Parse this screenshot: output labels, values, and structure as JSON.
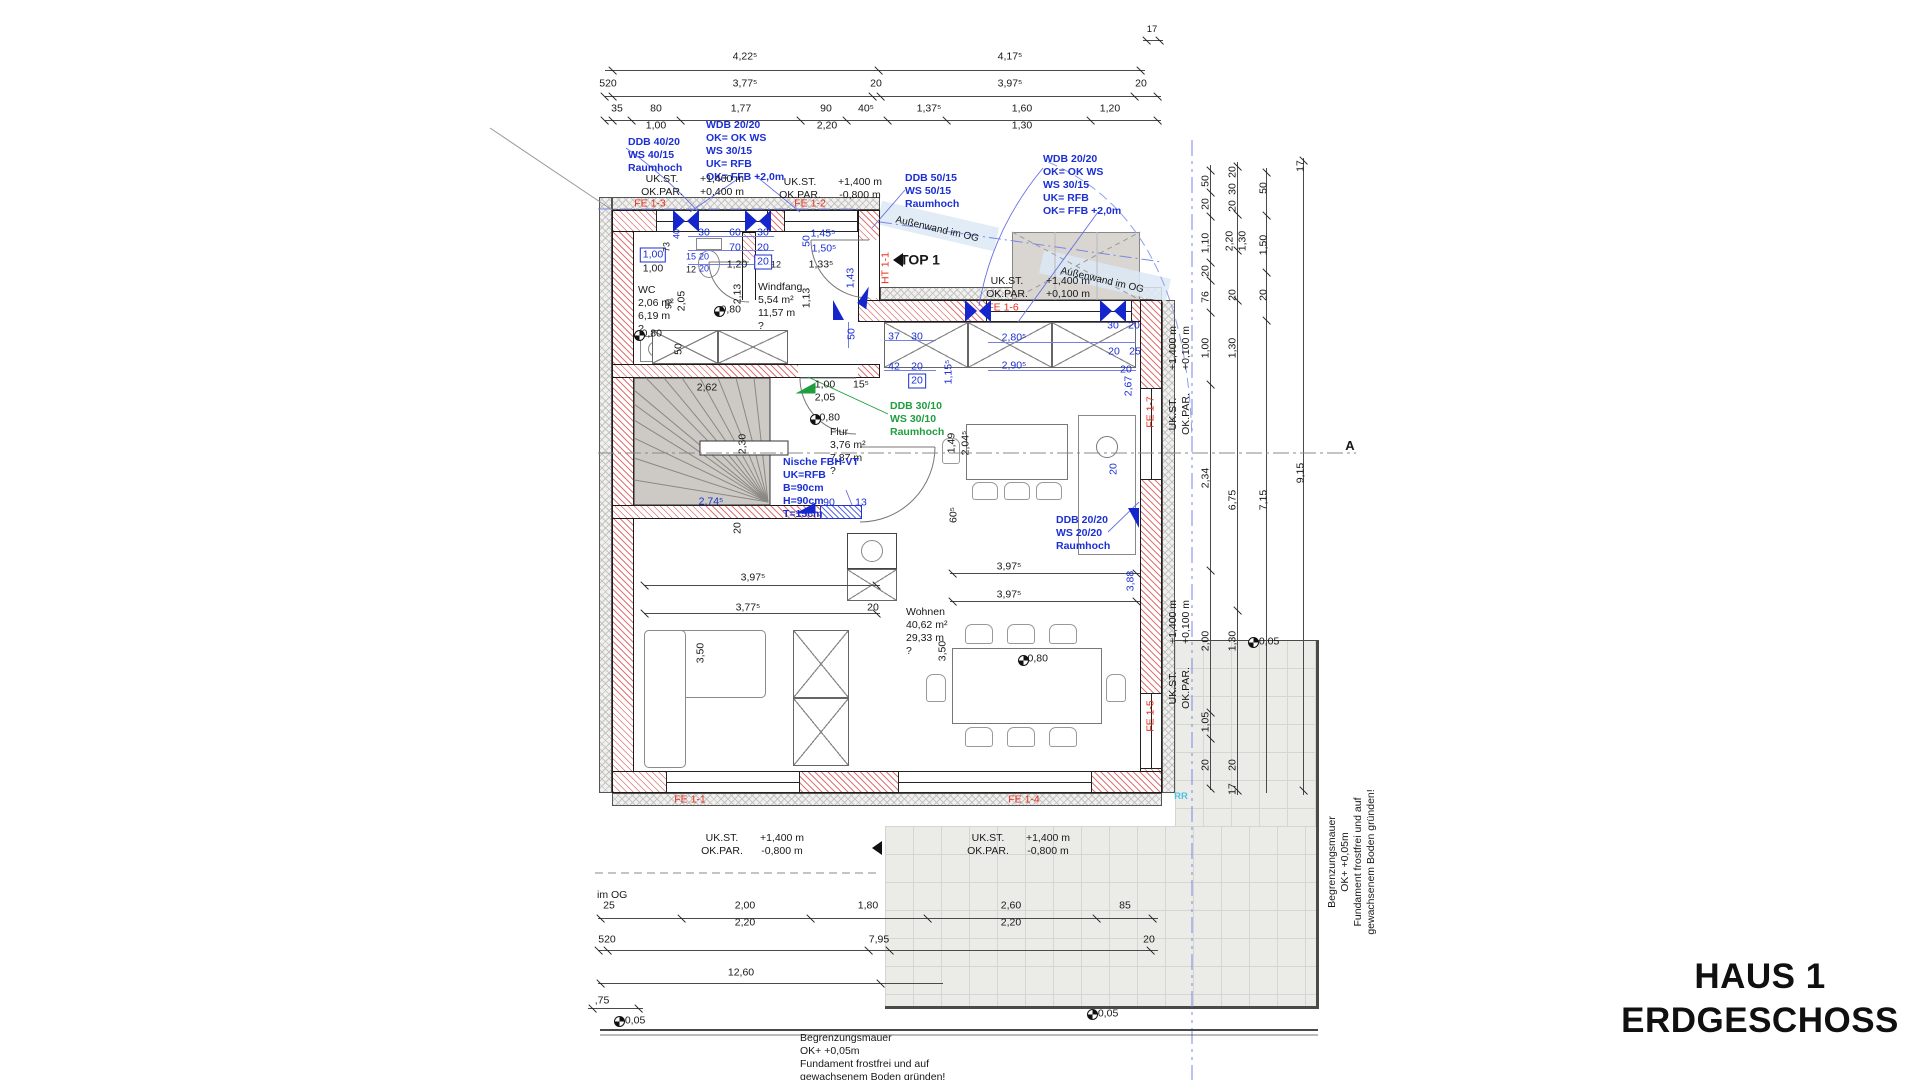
{
  "title": {
    "line1": "HAUS 1",
    "line2": "ERDGESCHOSS"
  },
  "accent_colors": {
    "dimension_blue": "#1b2fd4",
    "note_green": "#1f9e3e",
    "window_red": "#e8301c",
    "axis_cyan": "#49c4e6"
  },
  "labels": [
    {
      "t": "4,22⁵",
      "x": 745,
      "y": 57
    },
    {
      "t": "4,17⁵",
      "x": 1010,
      "y": 57
    },
    {
      "t": "17",
      "x": 1152,
      "y": 30,
      "s": 9.5
    },
    {
      "t": "520",
      "x": 608,
      "y": 84
    },
    {
      "t": "3,77⁵",
      "x": 745,
      "y": 84
    },
    {
      "t": "20",
      "x": 876,
      "y": 84
    },
    {
      "t": "3,97⁵",
      "x": 1010,
      "y": 84
    },
    {
      "t": "20",
      "x": 1141,
      "y": 84
    },
    {
      "t": "35",
      "x": 617,
      "y": 109
    },
    {
      "t": "80",
      "x": 656,
      "y": 109
    },
    {
      "t": "1,77",
      "x": 741,
      "y": 109
    },
    {
      "t": "90",
      "x": 826,
      "y": 109
    },
    {
      "t": "40⁵",
      "x": 866,
      "y": 109
    },
    {
      "t": "1,37⁵",
      "x": 929,
      "y": 109
    },
    {
      "t": "1,60",
      "x": 1022,
      "y": 109
    },
    {
      "t": "1,20",
      "x": 1110,
      "y": 109
    },
    {
      "t": "1,00",
      "x": 656,
      "y": 126
    },
    {
      "t": "2,20",
      "x": 827,
      "y": 126
    },
    {
      "t": "1,30",
      "x": 1022,
      "y": 126
    },
    {
      "n": "annotation-ddb-40",
      "t": "DDB 40/20\nWS 40/15\nRaumhoch",
      "x": 628,
      "y": 136,
      "c": "b",
      "a": "l",
      "fw": 1
    },
    {
      "n": "annotation-wdb-left",
      "t": "WDB 20/20\nOK= OK WS\nWS 30/15\nUK= RFB\nOK= FFB +2,0m",
      "x": 706,
      "y": 119,
      "c": "b",
      "a": "l",
      "fw": 1
    },
    {
      "n": "annotation-ddb-50",
      "t": "DDB 50/15\nWS 50/15\nRaumhoch",
      "x": 905,
      "y": 172,
      "c": "b",
      "a": "l",
      "fw": 1
    },
    {
      "n": "annotation-wdb-right",
      "t": "WDB 20/20\nOK= OK WS\nWS 30/15\nUK= RFB\nOK= FFB +2,0m",
      "x": 1043,
      "y": 153,
      "c": "b",
      "a": "l",
      "fw": 1
    },
    {
      "t": "UK.ST.\nOK.PAR.",
      "x": 662,
      "y": 186
    },
    {
      "t": "+1,400 m\n+0,400 m",
      "x": 722,
      "y": 186
    },
    {
      "t": "UK.ST.\nOK.PAR.",
      "x": 800,
      "y": 189
    },
    {
      "t": "+1,400 m\n-0,800 m",
      "x": 860,
      "y": 189
    },
    {
      "t": "UK.ST.\nOK.PAR.",
      "x": 1007,
      "y": 288
    },
    {
      "t": "+1,400 m\n+0,100 m",
      "x": 1068,
      "y": 288
    },
    {
      "n": "window-label-fe1-3",
      "t": "FE 1-3",
      "x": 650,
      "y": 204,
      "c": "r"
    },
    {
      "n": "window-label-fe1-2",
      "t": "FE 1-2",
      "x": 810,
      "y": 204,
      "c": "r"
    },
    {
      "n": "window-label-fe1-6",
      "t": "FE 1-6",
      "x": 1003,
      "y": 308,
      "c": "r"
    },
    {
      "n": "door-label-ht1-1",
      "t": "HT 1-1",
      "x": 886,
      "y": 268,
      "c": "r",
      "r": -90
    },
    {
      "n": "window-label-fe1-7",
      "t": "FE 1-7",
      "x": 1151,
      "y": 412,
      "c": "r",
      "r": -90
    },
    {
      "n": "window-label-fe1-5",
      "t": "FE 1-5",
      "x": 1151,
      "y": 716,
      "c": "r",
      "r": -90
    },
    {
      "n": "window-label-fe1-1",
      "t": "FE 1-1",
      "x": 690,
      "y": 800,
      "c": "r"
    },
    {
      "n": "window-label-fe1-4",
      "t": "FE 1-4",
      "x": 1024,
      "y": 800,
      "c": "r"
    },
    {
      "n": "og-wall-note",
      "t": "Außenwand im OG",
      "x": 937,
      "y": 230,
      "r": 13,
      "s": 10
    },
    {
      "n": "og-wall-note",
      "t": "Außenwand im OG",
      "x": 1102,
      "y": 281,
      "r": 13,
      "s": 10
    },
    {
      "n": "top1-label",
      "t": "TOP 1",
      "x": 920,
      "y": 260,
      "s": 14,
      "fw": 1
    },
    {
      "n": "room-wc",
      "t": "WC\n2,06 m²\n6,19 m\n?",
      "x": 638,
      "y": 284,
      "a": "l"
    },
    {
      "t": "90",
      "x": 669,
      "y": 304,
      "r": -90,
      "s": 9
    },
    {
      "t": "2,05",
      "x": 682,
      "y": 301,
      "r": -90
    },
    {
      "t": "-0,80",
      "x": 729,
      "y": 310
    },
    {
      "t": "2,13",
      "x": 738,
      "y": 294,
      "r": -90
    },
    {
      "n": "room-windfang",
      "t": "Windfang\n5,54 m²\n11,57 m\n?",
      "x": 758,
      "y": 281,
      "a": "l"
    },
    {
      "t": "1,13",
      "x": 807,
      "y": 298,
      "r": -90
    },
    {
      "t": "-0,80",
      "x": 650,
      "y": 334
    },
    {
      "t": "50",
      "x": 679,
      "y": 349,
      "r": -90
    },
    {
      "t": "1,00",
      "x": 653,
      "y": 255,
      "c": "b",
      "bx": 1
    },
    {
      "t": "1,00",
      "x": 653,
      "y": 269
    },
    {
      "t": "40",
      "x": 677,
      "y": 234,
      "r": -90,
      "c": "b",
      "s": 9
    },
    {
      "t": "73",
      "x": 667,
      "y": 247,
      "r": -90,
      "s": 9
    },
    {
      "t": "15",
      "x": 691,
      "y": 257,
      "c": "b",
      "s": 9
    },
    {
      "t": "20",
      "x": 704,
      "y": 257,
      "c": "b",
      "s": 9
    },
    {
      "t": "20",
      "x": 704,
      "y": 269,
      "c": "b",
      "s": 9
    },
    {
      "t": "12",
      "x": 691,
      "y": 270,
      "s": 9
    },
    {
      "t": "30",
      "x": 704,
      "y": 233,
      "c": "b"
    },
    {
      "t": "60",
      "x": 735,
      "y": 233,
      "c": "b"
    },
    {
      "t": "30",
      "x": 763,
      "y": 233,
      "c": "b"
    },
    {
      "t": "70",
      "x": 735,
      "y": 248,
      "c": "b"
    },
    {
      "t": "20",
      "x": 763,
      "y": 248,
      "c": "b"
    },
    {
      "t": "20",
      "x": 763,
      "y": 262,
      "c": "b",
      "bx": 1
    },
    {
      "t": "1,20",
      "x": 737,
      "y": 265
    },
    {
      "t": "12",
      "x": 776,
      "y": 265,
      "s": 9
    },
    {
      "t": "1,45⁵",
      "x": 823,
      "y": 234,
      "c": "b"
    },
    {
      "t": "1,50⁵",
      "x": 824,
      "y": 249,
      "c": "b"
    },
    {
      "t": "1,33⁵",
      "x": 821,
      "y": 265
    },
    {
      "t": "50",
      "x": 807,
      "y": 241,
      "r": -90,
      "c": "b"
    },
    {
      "t": "1,43",
      "x": 851,
      "y": 278,
      "r": -90,
      "c": "b"
    },
    {
      "t": "2,62",
      "x": 707,
      "y": 388
    },
    {
      "t": "2,30",
      "x": 743,
      "y": 444,
      "r": -90
    },
    {
      "t": "1,00",
      "x": 825,
      "y": 385
    },
    {
      "t": "2,05",
      "x": 825,
      "y": 398
    },
    {
      "t": "15⁵",
      "x": 861,
      "y": 385
    },
    {
      "t": "50",
      "x": 852,
      "y": 334,
      "r": -90,
      "c": "b"
    },
    {
      "t": "37",
      "x": 894,
      "y": 337,
      "c": "b"
    },
    {
      "t": "30",
      "x": 917,
      "y": 337,
      "c": "b"
    },
    {
      "t": "42",
      "x": 894,
      "y": 367,
      "c": "b"
    },
    {
      "t": "20",
      "x": 917,
      "y": 367,
      "c": "b"
    },
    {
      "t": "20",
      "x": 917,
      "y": 381,
      "c": "b",
      "bx": 1
    },
    {
      "t": "1,15⁵",
      "x": 949,
      "y": 372,
      "r": -90,
      "c": "b"
    },
    {
      "t": "2,80⁵",
      "x": 1014,
      "y": 338,
      "c": "b"
    },
    {
      "t": "2,90⁵",
      "x": 1014,
      "y": 366,
      "c": "b"
    },
    {
      "t": "30",
      "x": 1113,
      "y": 326,
      "c": "b"
    },
    {
      "t": "20",
      "x": 1134,
      "y": 326,
      "c": "b"
    },
    {
      "t": "20",
      "x": 1114,
      "y": 352,
      "c": "b"
    },
    {
      "t": "25",
      "x": 1135,
      "y": 352,
      "c": "b"
    },
    {
      "t": "20",
      "x": 1126,
      "y": 370,
      "c": "b"
    },
    {
      "t": "2,67",
      "x": 1129,
      "y": 386,
      "r": -90,
      "c": "b"
    },
    {
      "n": "annotation-ddb-30",
      "t": "DDB 30/10\nWS 30/10\nRaumhoch",
      "x": 890,
      "y": 400,
      "c": "g",
      "a": "l",
      "fw": 1
    },
    {
      "t": "-0,80",
      "x": 828,
      "y": 418
    },
    {
      "n": "room-flur",
      "t": "Flur\n3,76 m²\n7,87 m\n?",
      "x": 830,
      "y": 426,
      "a": "l"
    },
    {
      "t": "1,49",
      "x": 952,
      "y": 443,
      "r": -90
    },
    {
      "t": "2,04⁵",
      "x": 966,
      "y": 443,
      "r": -90
    },
    {
      "n": "annotation-nische",
      "t": "Nische FBH-VT\nUK=RFB\nB=90cm\nH=90cm\nT=15cm",
      "x": 783,
      "y": 456,
      "c": "b",
      "a": "l",
      "fw": 1
    },
    {
      "t": "2,74⁵",
      "x": 711,
      "y": 502,
      "c": "b"
    },
    {
      "t": "90",
      "x": 829,
      "y": 503,
      "c": "b"
    },
    {
      "t": "13",
      "x": 861,
      "y": 503,
      "c": "b"
    },
    {
      "t": "20",
      "x": 738,
      "y": 528,
      "r": -90
    },
    {
      "t": "60⁵",
      "x": 954,
      "y": 515,
      "r": -90
    },
    {
      "t": "3,97⁵",
      "x": 753,
      "y": 578
    },
    {
      "t": "3,77⁵",
      "x": 748,
      "y": 608
    },
    {
      "t": "20",
      "x": 873,
      "y": 608
    },
    {
      "t": "3,97⁵",
      "x": 1009,
      "y": 567
    },
    {
      "t": "3,97⁵",
      "x": 1009,
      "y": 595
    },
    {
      "n": "room-wohnen",
      "t": "Wohnen\n40,62 m²\n29,33 m\n?",
      "x": 906,
      "y": 606,
      "a": "l"
    },
    {
      "t": "3,50",
      "x": 701,
      "y": 653,
      "r": -90
    },
    {
      "t": "3,50",
      "x": 943,
      "y": 651,
      "r": -90
    },
    {
      "t": "-0,80",
      "x": 1036,
      "y": 659
    },
    {
      "t": "3,88",
      "x": 1131,
      "y": 581,
      "r": -90,
      "c": "b"
    },
    {
      "n": "annotation-ddb-20",
      "t": "DDB 20/20\nWS 20/20\nRaumhoch",
      "x": 1056,
      "y": 514,
      "c": "b",
      "a": "l",
      "fw": 1
    },
    {
      "t": "20",
      "x": 1114,
      "y": 469,
      "r": -90,
      "c": "b"
    },
    {
      "t": "+1,400 m\n+0,100 m",
      "x": 1180,
      "y": 348,
      "r": -90
    },
    {
      "t": "UK.ST.\nOK.PAR.",
      "x": 1180,
      "y": 414,
      "r": -90
    },
    {
      "t": "+1,400 m\n+0,100 m",
      "x": 1180,
      "y": 622,
      "r": -90
    },
    {
      "t": "UK.ST.\nOK.PAR.",
      "x": 1180,
      "y": 688,
      "r": -90
    },
    {
      "t": "50",
      "x": 1206,
      "y": 181,
      "r": -90
    },
    {
      "t": "20",
      "x": 1206,
      "y": 204,
      "r": -90
    },
    {
      "t": "1,10",
      "x": 1206,
      "y": 243,
      "r": -90
    },
    {
      "t": "20",
      "x": 1206,
      "y": 271,
      "r": -90
    },
    {
      "t": "76",
      "x": 1206,
      "y": 297,
      "r": -90
    },
    {
      "t": "1,00",
      "x": 1206,
      "y": 348,
      "r": -90
    },
    {
      "t": "2,34",
      "x": 1206,
      "y": 478,
      "r": -90
    },
    {
      "t": "2,00",
      "x": 1206,
      "y": 641,
      "r": -90
    },
    {
      "t": "1,05",
      "x": 1206,
      "y": 722,
      "r": -90
    },
    {
      "t": "20",
      "x": 1206,
      "y": 765,
      "r": -90
    },
    {
      "t": "20",
      "x": 1233,
      "y": 172,
      "r": -90
    },
    {
      "t": "30",
      "x": 1233,
      "y": 189,
      "r": -90
    },
    {
      "t": "20",
      "x": 1233,
      "y": 206,
      "r": -90
    },
    {
      "t": "2,20",
      "x": 1230,
      "y": 241,
      "r": -90
    },
    {
      "t": "1,30",
      "x": 1243,
      "y": 241,
      "r": -90
    },
    {
      "t": "20",
      "x": 1233,
      "y": 295,
      "r": -90
    },
    {
      "t": "1,30",
      "x": 1233,
      "y": 348,
      "r": -90
    },
    {
      "t": "6,75",
      "x": 1233,
      "y": 500,
      "r": -90
    },
    {
      "t": "1,30",
      "x": 1233,
      "y": 641,
      "r": -90
    },
    {
      "t": "20",
      "x": 1233,
      "y": 765,
      "r": -90
    },
    {
      "t": "17",
      "x": 1233,
      "y": 789,
      "r": -90
    },
    {
      "t": "50",
      "x": 1264,
      "y": 188,
      "r": -90
    },
    {
      "t": "1,50",
      "x": 1264,
      "y": 245,
      "r": -90
    },
    {
      "t": "20",
      "x": 1264,
      "y": 295,
      "r": -90
    },
    {
      "t": "7,15",
      "x": 1264,
      "y": 500,
      "r": -90
    },
    {
      "t": "17",
      "x": 1301,
      "y": 166,
      "r": -90
    },
    {
      "t": "9,15",
      "x": 1301,
      "y": 473,
      "r": -90
    },
    {
      "t": "+0,05",
      "x": 1266,
      "y": 642
    },
    {
      "n": "axis-label-rr",
      "t": "RR",
      "x": 1181,
      "y": 797,
      "c": "c",
      "fw": 1,
      "s": 9.5
    },
    {
      "n": "section-marker-a",
      "t": "A",
      "x": 1350,
      "y": 446,
      "s": 13,
      "fw": 1
    },
    {
      "n": "og-line-note",
      "t": "im OG",
      "x": 597,
      "y": 889,
      "a": "l"
    },
    {
      "t": "25",
      "x": 609,
      "y": 906
    },
    {
      "t": "2,00",
      "x": 745,
      "y": 906
    },
    {
      "t": "1,80",
      "x": 868,
      "y": 906
    },
    {
      "t": "2,60",
      "x": 1011,
      "y": 906
    },
    {
      "t": "85",
      "x": 1125,
      "y": 906
    },
    {
      "t": "2,20",
      "x": 745,
      "y": 923
    },
    {
      "t": "2,20",
      "x": 1011,
      "y": 923
    },
    {
      "t": "520",
      "x": 607,
      "y": 940
    },
    {
      "t": "7,95",
      "x": 879,
      "y": 940
    },
    {
      "t": "20",
      "x": 1149,
      "y": 940
    },
    {
      "t": "12,60",
      "x": 741,
      "y": 973
    },
    {
      "t": ",75",
      "x": 602,
      "y": 1001
    },
    {
      "t": "+0,05",
      "x": 632,
      "y": 1021
    },
    {
      "t": "+0,05",
      "x": 1105,
      "y": 1014
    },
    {
      "t": "UK.ST.\nOK.PAR.",
      "x": 722,
      "y": 845
    },
    {
      "t": "+1,400 m\n-0,800 m",
      "x": 782,
      "y": 845
    },
    {
      "t": "UK.ST.\nOK.PAR.",
      "x": 988,
      "y": 845
    },
    {
      "t": "+1,400 m\n-0,800 m",
      "x": 1048,
      "y": 845
    },
    {
      "n": "note-begrenzungsmauer-bottom",
      "t": "Begrenzungsmauer\nOK+ +0,05m\nFundament frostfrei und auf\ngewachsenem Boden gründen!",
      "x": 800,
      "y": 1032,
      "a": "l"
    },
    {
      "n": "note-begrenzungsmauer-right",
      "t": "Begrenzungsmauer\nOK+ +0,05m\nFundament frostfrei und auf\ngewachsenem Boden gründen!",
      "x": 1352,
      "y": 862,
      "r": -90
    }
  ],
  "icons": {
    "level_marker_icon": [
      {
        "x": 714,
        "y": 306
      },
      {
        "x": 634,
        "y": 330
      },
      {
        "x": 810,
        "y": 414
      },
      {
        "x": 1018,
        "y": 655
      },
      {
        "x": 1248,
        "y": 637
      },
      {
        "x": 614,
        "y": 1016
      },
      {
        "x": 1087,
        "y": 1009
      }
    ],
    "window_axis_icon": [
      {
        "x": 673,
        "y": 210
      },
      {
        "x": 745,
        "y": 210
      },
      {
        "x": 965,
        "y": 300
      },
      {
        "x": 1100,
        "y": 300
      }
    ],
    "marker_triangle_icon": [
      {
        "x": 833,
        "y": 300,
        "r": 0
      },
      {
        "x": 800,
        "y": 498,
        "r": -90
      },
      {
        "x": 1128,
        "y": 508,
        "r": 180
      },
      {
        "x": 862,
        "y": 288,
        "r": 35
      },
      {
        "x": 800,
        "y": 378,
        "r": -90,
        "c": "g"
      }
    ],
    "direction_arrow_icon": [
      {
        "x": 893,
        "y": 253
      },
      {
        "x": 872,
        "y": 841
      }
    ]
  }
}
